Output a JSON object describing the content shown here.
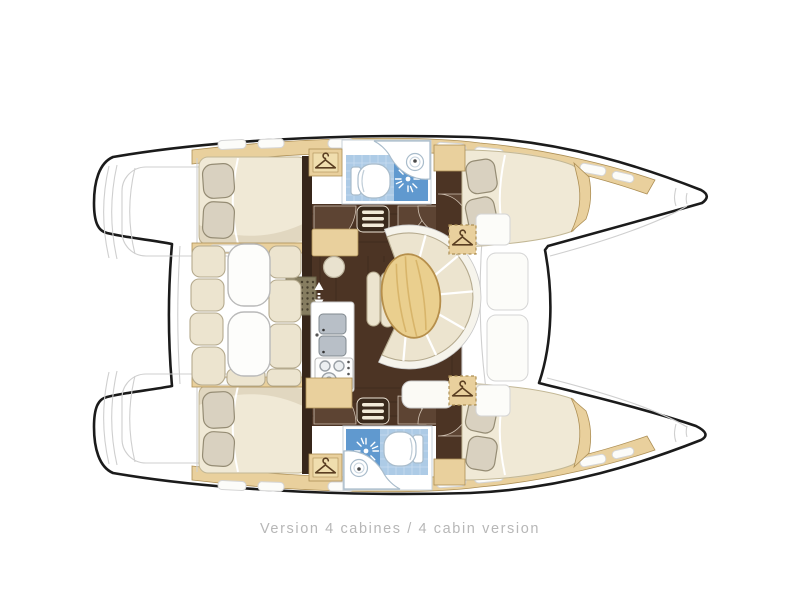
{
  "caption": {
    "text": "Version 4 cabines / 4 cabin version"
  },
  "diagram": {
    "type": "boat-floor-plan",
    "subject": "catamaran deck and accommodation layout, bow to the right",
    "depicted_features": [
      "4 double cabins with pillows",
      "2 heads with toilet, washbasin and shower",
      "saloon with oval table, curved settee and nav table with stool",
      "galley with double sink and stove",
      "aft cockpit with bench seating and two tables",
      "twin stern boarding platforms",
      "wardrobe lockers marked with hanger icons",
      "companionway steps with up-down arrows"
    ]
  },
  "icons": {
    "wardrobe": "hanger-icon",
    "shower": "sunburst-icon",
    "toilet": "toilet-icon",
    "washbasin": "basin-icon",
    "galley_sink": "double-basin-icon",
    "stove": "burners-icon",
    "companionway": "up-down-arrow-icon",
    "steps": "tread-bars-icon",
    "deck_hatch": "rounded-slot-icon"
  },
  "colors": {
    "background": "#ffffff",
    "outline": "#1b1b1b",
    "deck_line": "#cfcfcf",
    "sand": "#e9d09d",
    "sand_inner": "#f0deae",
    "sand_border": "#ad8f55",
    "wood": "#4c3424",
    "wood_wall": "#37261a",
    "door_wood": "#5d4433",
    "cushion": "#ece4cf",
    "cushion_border": "#b5aa8e",
    "backrest": "#f6f4ec",
    "pillow": "#d9d1c0",
    "pillow_border": "#958c74",
    "mattress": "#f0e9d6",
    "table_wood": "#eacf8e",
    "table_grain": "#d3ae62",
    "table_border": "#b68f4b",
    "white_fixture": "#ffffff",
    "fixture_border": "#a9bccb",
    "tile": "#adcbe6",
    "tile_line": "#c8dcf0",
    "shower": "#6099cf",
    "steel": "#b8bfc7",
    "steel_border": "#81898f",
    "mat": "#867d60",
    "mat_dot": "#473f2d",
    "caption": "#b7b7b7"
  }
}
